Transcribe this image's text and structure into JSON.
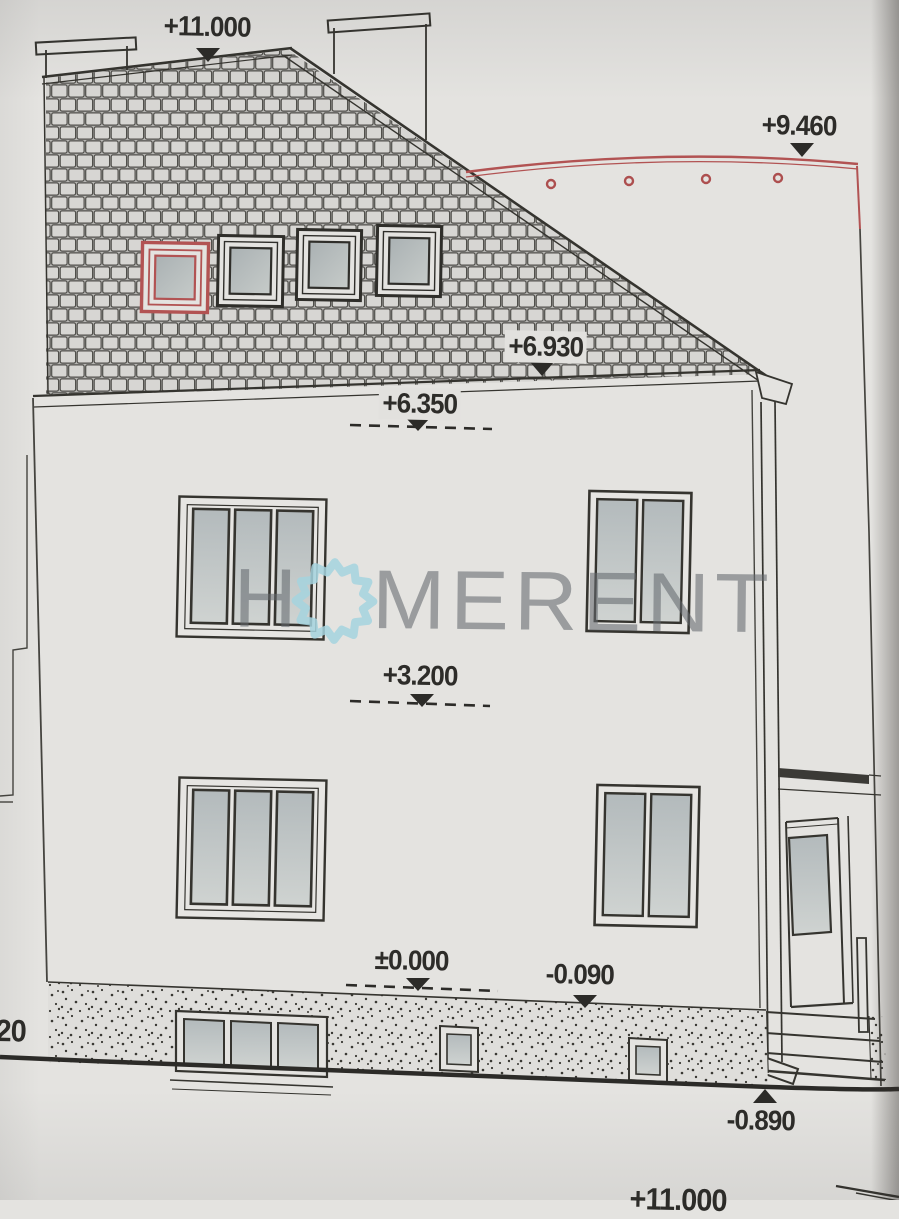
{
  "labels": {
    "ridge": "+11.000",
    "right_roof": "+9.460",
    "eaves": "+6.930",
    "attic_floor": "+6.350",
    "second_floor": "+3.200",
    "ground_floor": "±0.000",
    "plinth_top": "-0.090",
    "terrain": "-0.890",
    "next_sheet_partial": "+11.000",
    "left_edge_partial": "20"
  },
  "watermark": {
    "prefix": "H",
    "suffix": "MERENT",
    "flower_icon": "flower-sun-icon",
    "text_color": "#64696e",
    "flower_color": "#a9d3dc"
  },
  "colors": {
    "paper": "#e4e3e0",
    "ink": "#35342f",
    "proposal_red": "#b25353",
    "tile_fill": "#d7d6d3",
    "tile_joint": "#504f4b",
    "glass_top": "#b3babc",
    "glass_bottom": "#cfd3d1"
  }
}
